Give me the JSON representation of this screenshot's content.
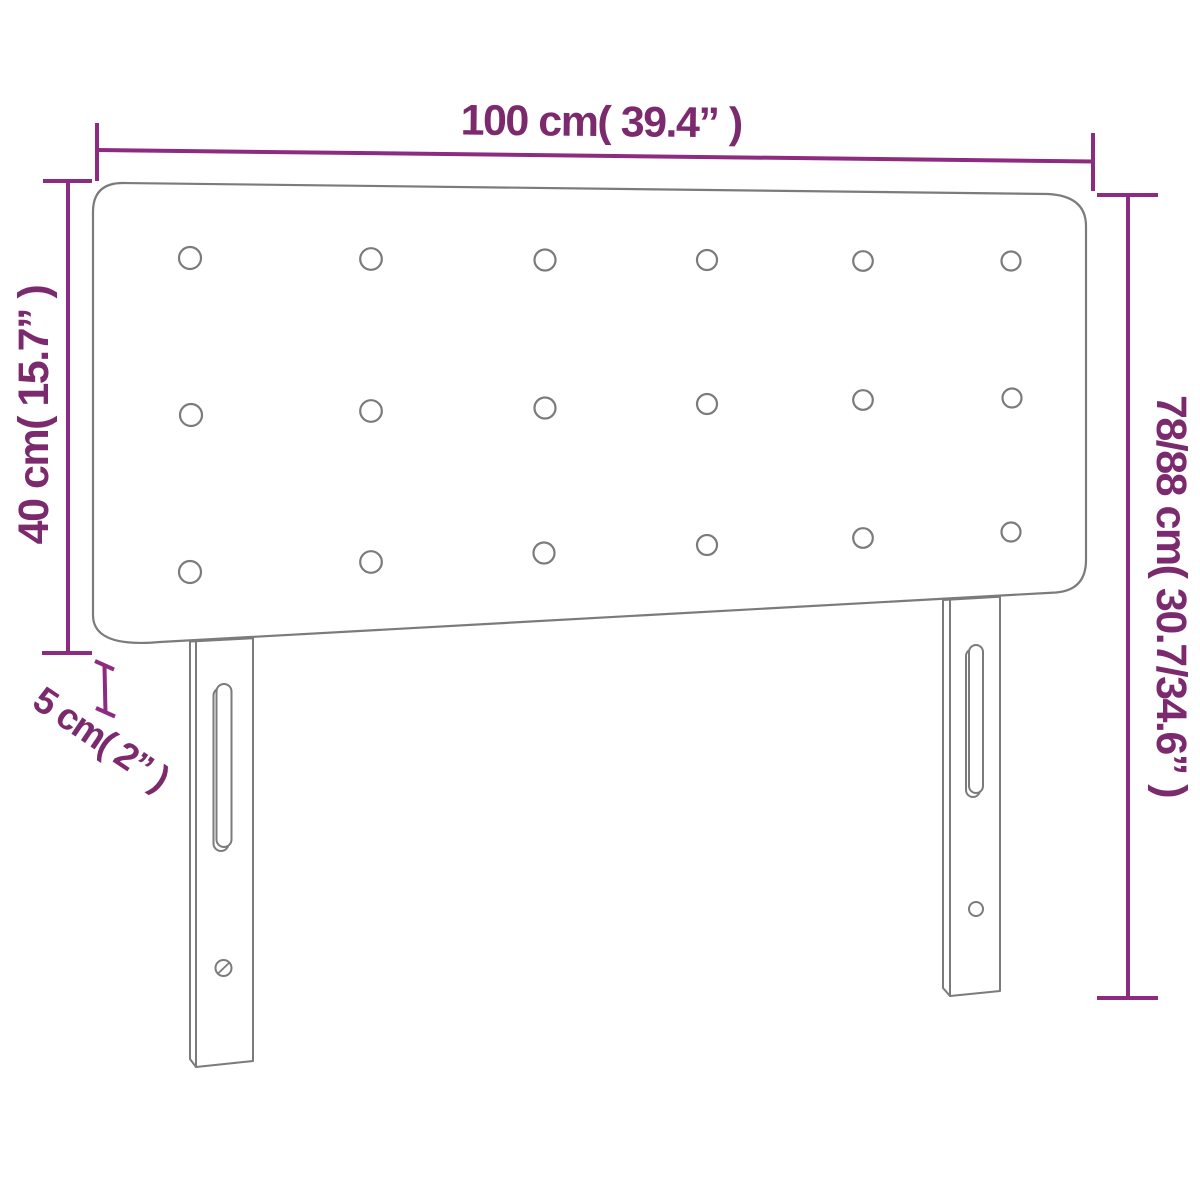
{
  "page": {
    "title": "Headboard dimension diagram",
    "background": "#ffffff"
  },
  "labels": {
    "width": "100 cm( 39.4” )",
    "upholstered_height": "40 cm( 15.7” )",
    "thickness": "5 cm( 2” )",
    "total_height": "78/88 cm( 30.7/34.6” )"
  },
  "dimensions": {
    "width_cm": 100,
    "width_in": 39.4,
    "upholstered_height_cm": 40,
    "upholstered_height_in": 15.7,
    "thickness_cm": 5,
    "thickness_in": 2,
    "total_height_cm": "78/88",
    "total_height_in": "30.7/34.6"
  },
  "colors": {
    "outline_gray": "#7b7b7b",
    "dimension_purple": "#8c2b80",
    "text_purple": "#7c2a6e",
    "fill_white": "#ffffff"
  },
  "drawing": {
    "panel": {
      "path": "M 93 212 Q 93 183 123 183 L 1048 194 Q 1086 196 1086 226 L 1086 560 Q 1086 590 1056 592.5 L 160 642 Q 94 648 93 616 Z"
    },
    "buttons": [
      {
        "cx": 190,
        "cy": 258,
        "r": 11
      },
      {
        "cx": 371,
        "cy": 259,
        "r": 10.8
      },
      {
        "cx": 545,
        "cy": 260,
        "r": 10.5
      },
      {
        "cx": 707,
        "cy": 260,
        "r": 10
      },
      {
        "cx": 863,
        "cy": 261,
        "r": 9.8
      },
      {
        "cx": 1011,
        "cy": 261,
        "r": 9.5
      },
      {
        "cx": 191,
        "cy": 415,
        "r": 11
      },
      {
        "cx": 371,
        "cy": 411,
        "r": 10.8
      },
      {
        "cx": 545,
        "cy": 408,
        "r": 10.5
      },
      {
        "cx": 707,
        "cy": 404,
        "r": 10
      },
      {
        "cx": 863,
        "cy": 400,
        "r": 9.8
      },
      {
        "cx": 1012,
        "cy": 398,
        "r": 9.5
      },
      {
        "cx": 190,
        "cy": 572,
        "r": 11
      },
      {
        "cx": 371,
        "cy": 562,
        "r": 10.8
      },
      {
        "cx": 544,
        "cy": 553,
        "r": 10.5
      },
      {
        "cx": 707,
        "cy": 545,
        "r": 10
      },
      {
        "cx": 863,
        "cy": 538,
        "r": 9.8
      },
      {
        "cx": 1011,
        "cy": 532,
        "r": 9.5
      }
    ],
    "legs": [
      {
        "name": "left-leg",
        "side_face": "M 190 641.5 L 196 641.3 L 196 1067 L 190 1059 Z",
        "front_face": "M 196 641.3 L 253 638.2 L 253 1061 L 196 1067 Z",
        "slot_inner": {
          "x": 213.5,
          "y": 688,
          "w": 15,
          "h": 163,
          "rx": 7.5
        },
        "slot_outer": {
          "x": 216.5,
          "y": 684,
          "w": 15,
          "h": 163,
          "rx": 7.5
        },
        "hole": {
          "cx": 223.5,
          "cy": 968,
          "r": 8
        },
        "hole_slash": [
          218,
          973.5,
          229.5,
          962.5
        ]
      },
      {
        "name": "right-leg",
        "side_face": "M 943 600 L 950 599.6 L 950 996 L 943 988 Z",
        "front_face": "M 950 599.6 L 1000 596.8 L 1000 991 L 950 996 Z",
        "slot_inner": {
          "x": 966,
          "y": 649,
          "w": 14,
          "h": 148,
          "rx": 7
        },
        "slot_outer": {
          "x": 969,
          "y": 645,
          "w": 14,
          "h": 148,
          "rx": 7
        },
        "hole": {
          "cx": 976,
          "cy": 909,
          "r": 7
        },
        "hole_slash": null
      }
    ],
    "dimension_lines": [
      {
        "name": "dimension-width",
        "lines": [
          [
            97,
            150,
            1093,
            161.5
          ],
          [
            97,
            123,
            97,
            181
          ],
          [
            1093,
            133,
            1093,
            191
          ]
        ],
        "label": {
          "bind": "labels.width",
          "x": 601,
          "y": 136,
          "rotate": 0.6,
          "size": 43
        }
      },
      {
        "name": "dimension-upholstered-height",
        "lines": [
          [
            68,
            181,
            68,
            653
          ],
          [
            43,
            181,
            92,
            181
          ],
          [
            42,
            653,
            92,
            653
          ]
        ],
        "label": {
          "bind": "labels.upholstered_height",
          "x": 48,
          "y": 415,
          "rotate": -90,
          "size": 43
        }
      },
      {
        "name": "dimension-total-height",
        "lines": [
          [
            1128,
            195,
            1128,
            998
          ],
          [
            1097,
            195,
            1158,
            195
          ],
          [
            1097,
            998,
            1158,
            998
          ]
        ],
        "label": {
          "bind": "labels.total_height",
          "x": 1157,
          "y": 596,
          "rotate": 90,
          "size": 43
        }
      },
      {
        "name": "dimension-thickness",
        "lines": [
          [
            104.5,
            666,
            105.5,
            713
          ],
          [
            95,
            661,
            114,
            669.5
          ],
          [
            96,
            708,
            115,
            716.5
          ]
        ],
        "label": {
          "bind": "labels.thickness",
          "x": 94,
          "y": 749,
          "rotate": 34,
          "size": 37
        }
      }
    ]
  }
}
